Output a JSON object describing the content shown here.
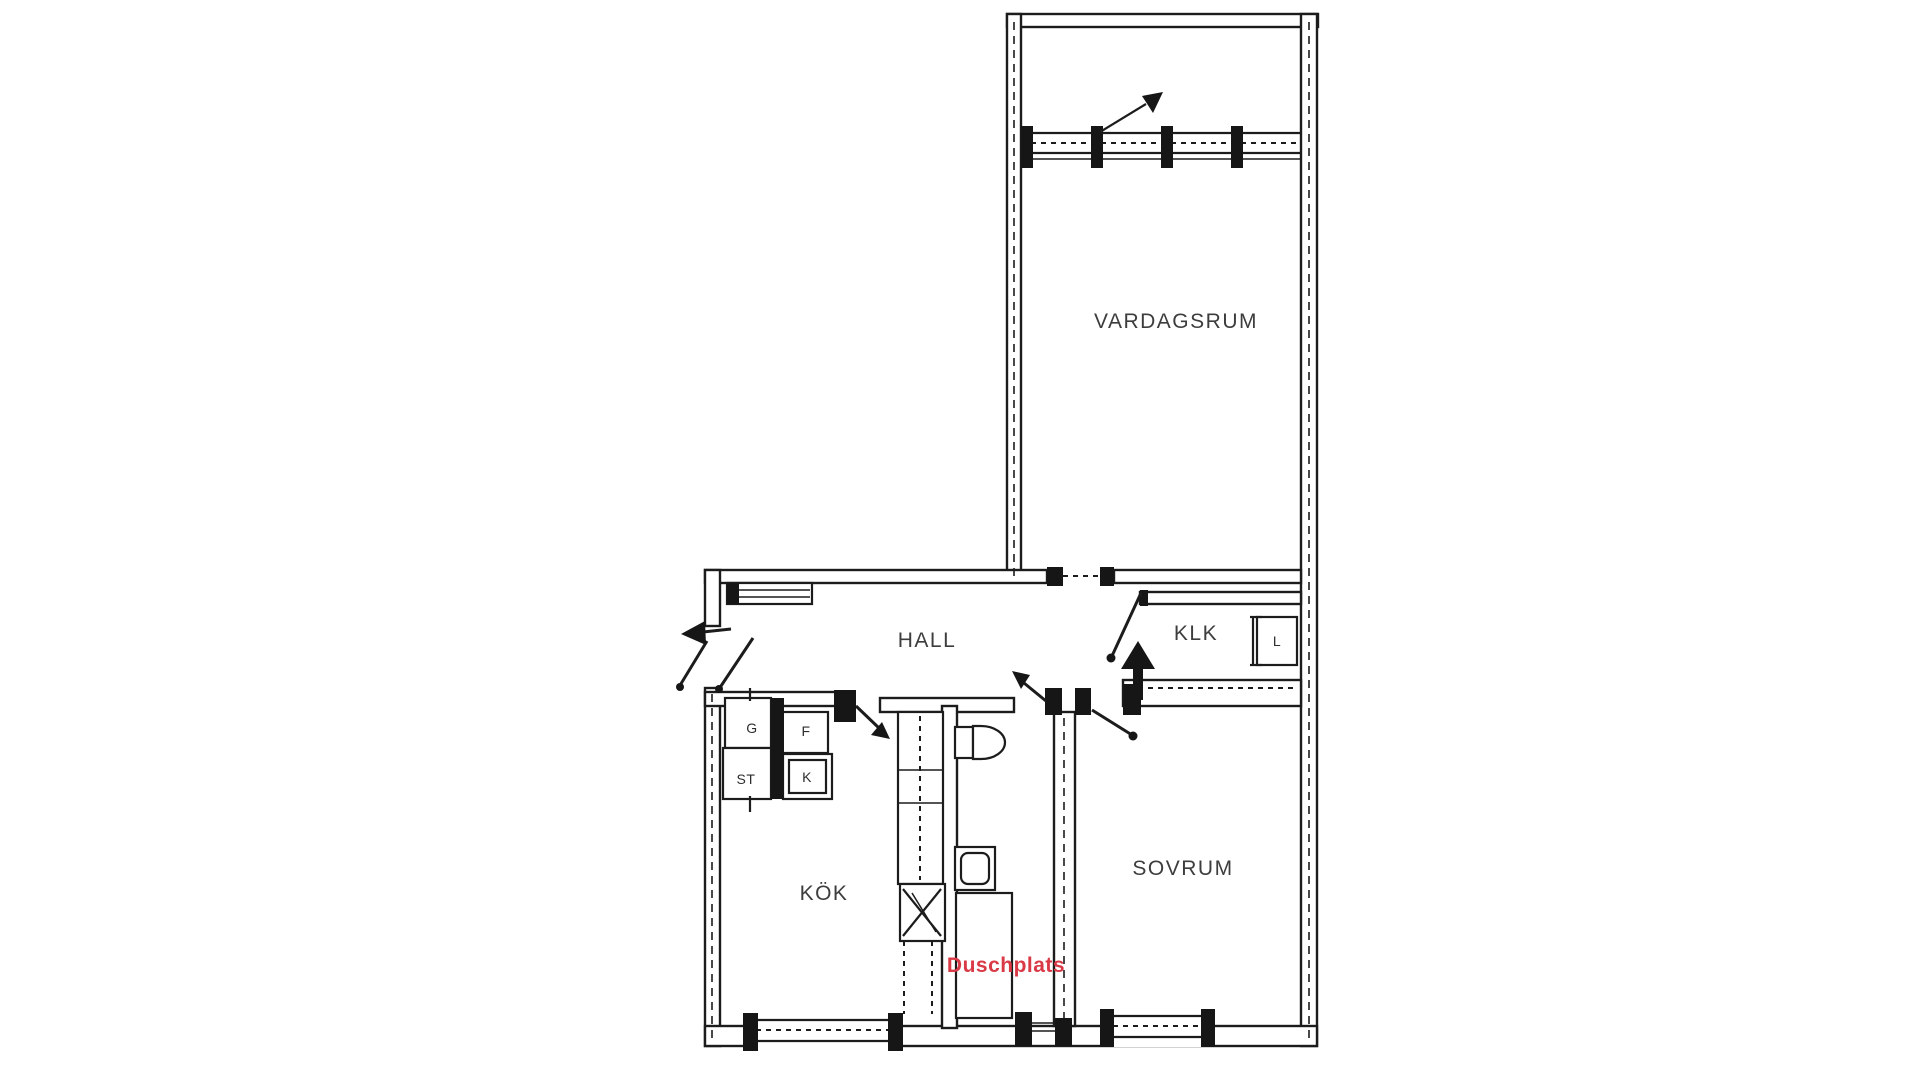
{
  "document": {
    "kind": "apartment floor plan drawing",
    "background_color": "#ffffff",
    "line_color": "#1c1c1c",
    "label_color": "#3d3d3d",
    "accent_red": "#d93a46"
  },
  "plan": {
    "rooms": {
      "vardagsrum": {
        "label": "VARDAGSRUM"
      },
      "hall": {
        "label": "HALL"
      },
      "klk": {
        "label": "KLK"
      },
      "kok": {
        "label": "KÖK"
      },
      "sovrum": {
        "label": "SOVRUM"
      },
      "duschplats": {
        "label": "Duschplats"
      }
    },
    "closets": {
      "g": {
        "label": "G"
      },
      "f": {
        "label": "F"
      },
      "st": {
        "label": "ST"
      },
      "k": {
        "label": "K"
      },
      "l": {
        "label": "L"
      }
    }
  }
}
